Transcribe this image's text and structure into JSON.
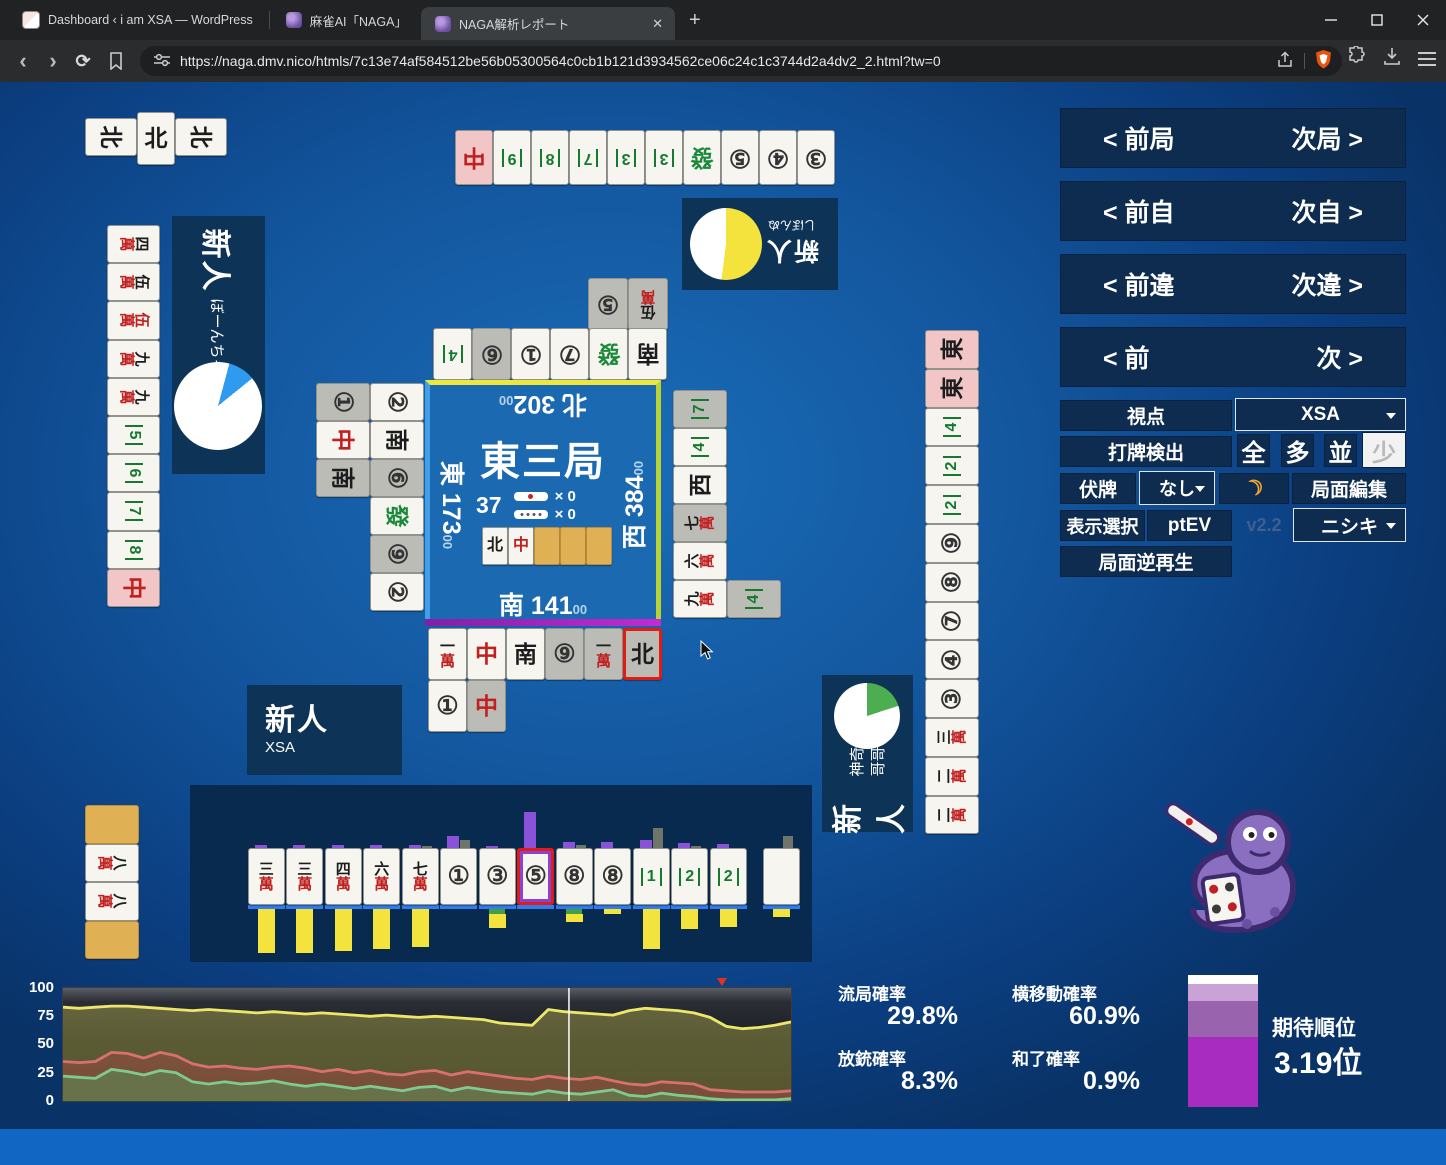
{
  "browser": {
    "tabs": [
      {
        "title": "Dashboard ‹ i am XSA — WordPress",
        "active": false,
        "favicon": "wordpress-site-icon"
      },
      {
        "title": "麻雀AI「NAGA」",
        "active": false,
        "favicon": "naga-snake-icon"
      },
      {
        "title": "NAGA解析レポート",
        "active": true,
        "favicon": "naga-snake-icon"
      }
    ],
    "new_tab_label": "+",
    "url": "https://naga.dmv.nico/htmls/7c13e74af584512be56b05300564c0cb1b121d3934562ce06c24c1c3744d2a4dv2_2.html?tw=0",
    "icons": {
      "back": "‹",
      "forward": "›",
      "reload": "⟳",
      "close_tab": "✕",
      "minimize": "–",
      "maximize": "▢",
      "close": "✕"
    }
  },
  "nav_panel": {
    "rows": [
      {
        "prev": "< 前局",
        "next": "次局 >"
      },
      {
        "prev": "< 前自",
        "next": "次自 >"
      },
      {
        "prev": "< 前違",
        "next": "次違 >"
      },
      {
        "prev": "< 前",
        "next": "次 >"
      }
    ],
    "viewpoint_label": "視点",
    "viewpoint_value": "XSA",
    "dahai_label": "打牌検出",
    "dahai_options": [
      "全",
      "多",
      "並",
      "少"
    ],
    "dahai_selected": "少",
    "fusehai_label": "伏牌",
    "fusehai_value": "なし",
    "moon_icon": "☽",
    "kyokumen_edit_label": "局面編集",
    "display_label": "表示選択",
    "display_value": "ptEV",
    "version": "v2.2",
    "model_value": "ニシキ",
    "reverse_play_label": "局面逆再生"
  },
  "center": {
    "round": "東三局",
    "wall_count": "37",
    "riichi_sticks": "× 0",
    "honba_sticks": "× 0",
    "wall_tiles": [
      "N",
      "C",
      "back",
      "back",
      "back"
    ]
  },
  "players": {
    "east": {
      "wind": "東",
      "score": "173",
      "score_sub": "00",
      "rank": "新人",
      "name": "ぼーんちゃ",
      "pie": {
        "color": "#2e9bf0",
        "pct": 10,
        "start": 15
      },
      "hand": [
        "4m",
        "5m",
        "0m",
        "9m",
        "9m",
        "5s",
        "6s",
        "7s",
        "8s",
        "C:p"
      ],
      "meld": [
        {
          "c": "back"
        },
        {
          "c": "8m",
          "o": "left"
        },
        {
          "c": "8m",
          "o": "left"
        },
        {
          "c": "back"
        }
      ],
      "discards": {
        "outer": [
          "1p:g",
          "C",
          "S:g"
        ],
        "inner": [
          "2p",
          "S",
          "6p:g",
          "F",
          "9p:g",
          "2p"
        ]
      }
    },
    "north": {
      "wind": "北",
      "score": "302",
      "score_sub": "00",
      "rank": "新人",
      "name": "しぼんぬ",
      "pie": {
        "color": "#f3e33c",
        "pct": 52,
        "start": 0
      },
      "hand": [
        "C:p",
        "9s",
        "8s",
        "7s",
        "3s",
        "3s",
        "F",
        "5p",
        "4p",
        "3p"
      ],
      "meld": [
        {
          "c": "N",
          "o": "left"
        },
        {
          "c": "N",
          "o": "up"
        },
        {
          "c": "N",
          "o": "left"
        }
      ],
      "discards": {
        "row1": [
          "4s",
          "6p:g",
          "1p",
          "7p",
          "F",
          "S"
        ],
        "row2": [
          "5p:g",
          "5m:g"
        ]
      }
    },
    "west": {
      "wind": "西",
      "score": "384",
      "score_sub": "00",
      "rank": "新人",
      "name": "神奇的大哥哥",
      "pie": {
        "color": "#4cae50",
        "pct": 20,
        "start": 0
      },
      "hand": [
        "E:p",
        "E:p",
        "4s",
        "2s",
        "2s",
        "9p",
        "8p",
        "7p",
        "4p",
        "3p",
        "3m",
        "2m",
        "2m"
      ],
      "discards": {
        "inner": [
          "7s:g",
          "4s",
          "W",
          "7m:g",
          "6m",
          "9m"
        ],
        "outer": [
          "4s:g"
        ]
      }
    },
    "south": {
      "wind": "南",
      "score": "141",
      "score_sub": "00",
      "rank": "新人",
      "name": "XSA",
      "hand": [
        "3m",
        "3m",
        "4m",
        "6m",
        "7m",
        "1p",
        "3p",
        "5p:w:sel2",
        "8p",
        "8p",
        "1s",
        "2s",
        "2s"
      ],
      "draw_tile": "blank",
      "hand_bars": [
        [
          3,
          0,
          44,
          0
        ],
        [
          3,
          0,
          44,
          0
        ],
        [
          3,
          0,
          42,
          0
        ],
        [
          3,
          0,
          40,
          0
        ],
        [
          3,
          2,
          38,
          0
        ],
        [
          12,
          8,
          0,
          0
        ],
        [
          2,
          0,
          14,
          1
        ],
        [
          36,
          0,
          0,
          0
        ],
        [
          6,
          3,
          8,
          1
        ],
        [
          6,
          0,
          5,
          0
        ],
        [
          8,
          20,
          40,
          0
        ],
        [
          5,
          2,
          20,
          0
        ],
        [
          4,
          0,
          18,
          0
        ]
      ],
      "draw_bars": [
        0,
        12,
        8,
        0
      ],
      "discards": {
        "row1": [
          "1m",
          "C",
          "S",
          "9p:g",
          "1m:g",
          "N:g:sel"
        ],
        "row2": [
          "1p",
          "C:g"
        ]
      }
    }
  },
  "stats": {
    "ryukyoku_label": "流局確率",
    "ryukyoku": "29.8%",
    "yokoido_label": "横移動確率",
    "yokoido": "60.9%",
    "hoju_label": "放銃確率",
    "hoju": "8.3%",
    "hora_label": "和了確率",
    "hora": "0.9%",
    "rank_label": "期待順位",
    "rank_value": "3.19位",
    "rank_bar": [
      {
        "color": "#ffffff",
        "pct": 7
      },
      {
        "color": "#c9a3d6",
        "pct": 13
      },
      {
        "color": "#9a63ae",
        "pct": 27
      },
      {
        "color": "#a92cc0",
        "pct": 53
      }
    ]
  },
  "chart_data": {
    "type": "area",
    "title": "",
    "ylim": [
      0,
      100
    ],
    "yticks": [
      "100",
      "75",
      "50",
      "25",
      "0"
    ],
    "grid": false,
    "legend": "none",
    "cursor_frac": 0.695,
    "marker_frac": 0.905,
    "series": [
      {
        "name": "yellow",
        "color": "#ece76a",
        "fill": "rgba(190,185,80,0.40)",
        "values": [
          83,
          82,
          83,
          84,
          84,
          83,
          82,
          81,
          80,
          81,
          80,
          79,
          78,
          79,
          78,
          77,
          78,
          77,
          76,
          75,
          76,
          75,
          74,
          75,
          74,
          73,
          72,
          69,
          68,
          67,
          81,
          79,
          78,
          77,
          76,
          80,
          82,
          81,
          80,
          78,
          74,
          66,
          64,
          65,
          67,
          70
        ]
      },
      {
        "name": "red",
        "color": "#d97070",
        "fill": "rgba(165,70,70,0.45)",
        "values": [
          35,
          34,
          35,
          43,
          42,
          38,
          43,
          40,
          33,
          30,
          31,
          29,
          28,
          30,
          31,
          29,
          26,
          28,
          25,
          27,
          24,
          23,
          26,
          27,
          23,
          26,
          24,
          22,
          20,
          19,
          22,
          20,
          19,
          21,
          18,
          15,
          14,
          17,
          16,
          15,
          10,
          9,
          8,
          8,
          8,
          9
        ]
      },
      {
        "name": "green",
        "color": "#7fca8c",
        "fill": "rgba(85,150,90,0.50)",
        "values": [
          22,
          21,
          20,
          28,
          26,
          23,
          27,
          25,
          17,
          15,
          17,
          15,
          16,
          18,
          15,
          13,
          15,
          13,
          11,
          13,
          11,
          9,
          12,
          13,
          9,
          12,
          10,
          8,
          7,
          6,
          9,
          7,
          6,
          8,
          10,
          5,
          4,
          7,
          5,
          4,
          2,
          1,
          1,
          1,
          1,
          2
        ]
      }
    ]
  }
}
